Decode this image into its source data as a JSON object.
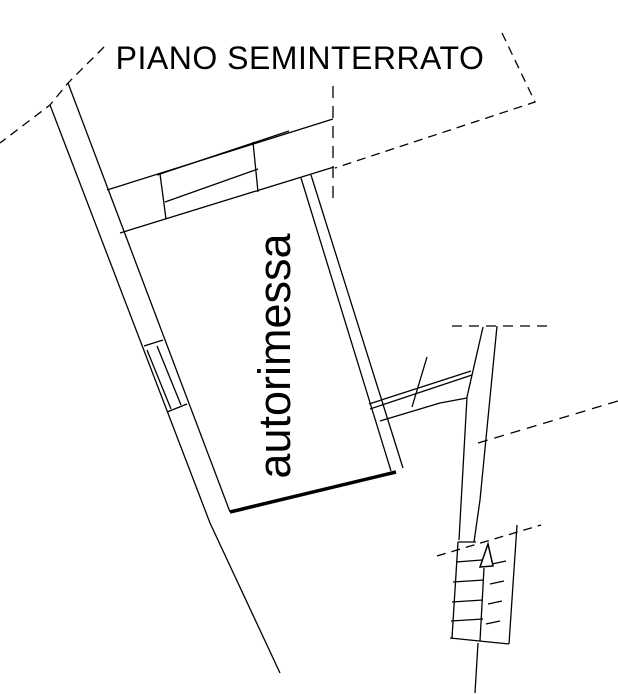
{
  "texts": {
    "title": "PIANO SEMINTERRATO",
    "room_label": "autorimessa"
  },
  "drawing": {
    "background": "#ffffff",
    "ink_color": "#000000",
    "thin_stroke": 1.3,
    "thick_stroke": 3.5,
    "solid_polylines": [
      [
        [
          68,
          83
        ],
        [
          230,
          512
        ]
      ],
      [
        [
          50,
          105
        ],
        [
          210,
          523
        ]
      ],
      [
        [
          107,
          190
        ],
        [
          333,
          119
        ]
      ],
      [
        [
          120,
          233
        ],
        [
          334,
          167
        ]
      ],
      [
        [
          157,
          175
        ],
        [
          289,
          131
        ]
      ],
      [
        [
          165,
          202
        ],
        [
          258,
          169
        ]
      ],
      [
        [
          160,
          174
        ],
        [
          166,
          219
        ]
      ],
      [
        [
          253,
          142
        ],
        [
          258,
          192
        ]
      ],
      [
        [
          301,
          178
        ],
        [
          391,
          471
        ]
      ],
      [
        [
          311,
          175
        ],
        [
          403,
          468
        ]
      ],
      [
        [
          210,
          523
        ],
        [
          280,
          673
        ]
      ],
      [
        [
          144,
          346
        ],
        [
          163,
          340
        ]
      ],
      [
        [
          167,
          412
        ],
        [
          187,
          404
        ]
      ],
      [
        [
          147,
          350
        ],
        [
          171,
          409
        ]
      ],
      [
        [
          157,
          346
        ],
        [
          181,
          405
        ]
      ],
      [
        [
          369,
          404
        ],
        [
          471,
          371
        ]
      ],
      [
        [
          370,
          409
        ],
        [
          472,
          375
        ]
      ],
      [
        [
          380,
          421
        ],
        [
          440,
          403
        ],
        [
          467,
          398
        ]
      ],
      [
        [
          427,
          357
        ],
        [
          412,
          407
        ]
      ],
      [
        [
          483,
          327
        ],
        [
          467,
          397
        ],
        [
          459,
          540
        ]
      ],
      [
        [
          497,
          326
        ],
        [
          480,
          500
        ],
        [
          474,
          542
        ]
      ],
      [
        [
          458,
          542
        ],
        [
          476,
          542
        ]
      ],
      [
        [
          458,
          542
        ],
        [
          452,
          638
        ]
      ],
      [
        [
          450,
          638
        ],
        [
          509,
          644
        ]
      ],
      [
        [
          509,
          644
        ],
        [
          517,
          525
        ]
      ],
      [
        [
          456,
          562
        ],
        [
          482,
          560
        ]
      ],
      [
        [
          453,
          582
        ],
        [
          484,
          580
        ]
      ],
      [
        [
          452,
          602
        ],
        [
          483,
          600
        ]
      ],
      [
        [
          451,
          621
        ],
        [
          483,
          619
        ]
      ],
      [
        [
          484,
          568
        ],
        [
          480,
          641
        ]
      ],
      [
        [
          478,
          643
        ],
        [
          475,
          693
        ]
      ],
      [
        [
          492,
          564
        ],
        [
          506,
          561
        ]
      ],
      [
        [
          490,
          584
        ],
        [
          504,
          581
        ]
      ],
      [
        [
          488,
          604
        ],
        [
          502,
          601
        ]
      ],
      [
        [
          486,
          624
        ],
        [
          500,
          621
        ]
      ]
    ],
    "thick_polylines": [
      [
        [
          230,
          512
        ],
        [
          396,
          472
        ]
      ]
    ],
    "dashed_polylines": [
      {
        "points": [
          [
            104,
            47
          ],
          [
            68,
            83
          ],
          [
            50,
            105
          ],
          [
            0,
            143
          ]
        ],
        "dash": "9 6"
      },
      {
        "points": [
          [
            502,
            33
          ],
          [
            535,
            102
          ],
          [
            335,
            168
          ]
        ],
        "dash": "9 6"
      },
      {
        "points": [
          [
            333,
            86
          ],
          [
            333,
            198
          ]
        ],
        "dash": "12 8"
      },
      {
        "points": [
          [
            452,
            326
          ],
          [
            551,
            326
          ]
        ],
        "dash": "10 7"
      },
      {
        "points": [
          [
            478,
            443
          ],
          [
            618,
            401
          ]
        ],
        "dash": "10 7"
      },
      {
        "points": [
          [
            437,
            556
          ],
          [
            541,
            525
          ]
        ],
        "dash": "9 6"
      }
    ],
    "arrow_triangle": [
      [
        488,
        544
      ],
      [
        480,
        567
      ],
      [
        493,
        566
      ]
    ],
    "title_pos": {
      "x": 300,
      "y": 69
    },
    "room_label_pos": {
      "x": 290,
      "y": 356,
      "rotation": -90
    }
  }
}
